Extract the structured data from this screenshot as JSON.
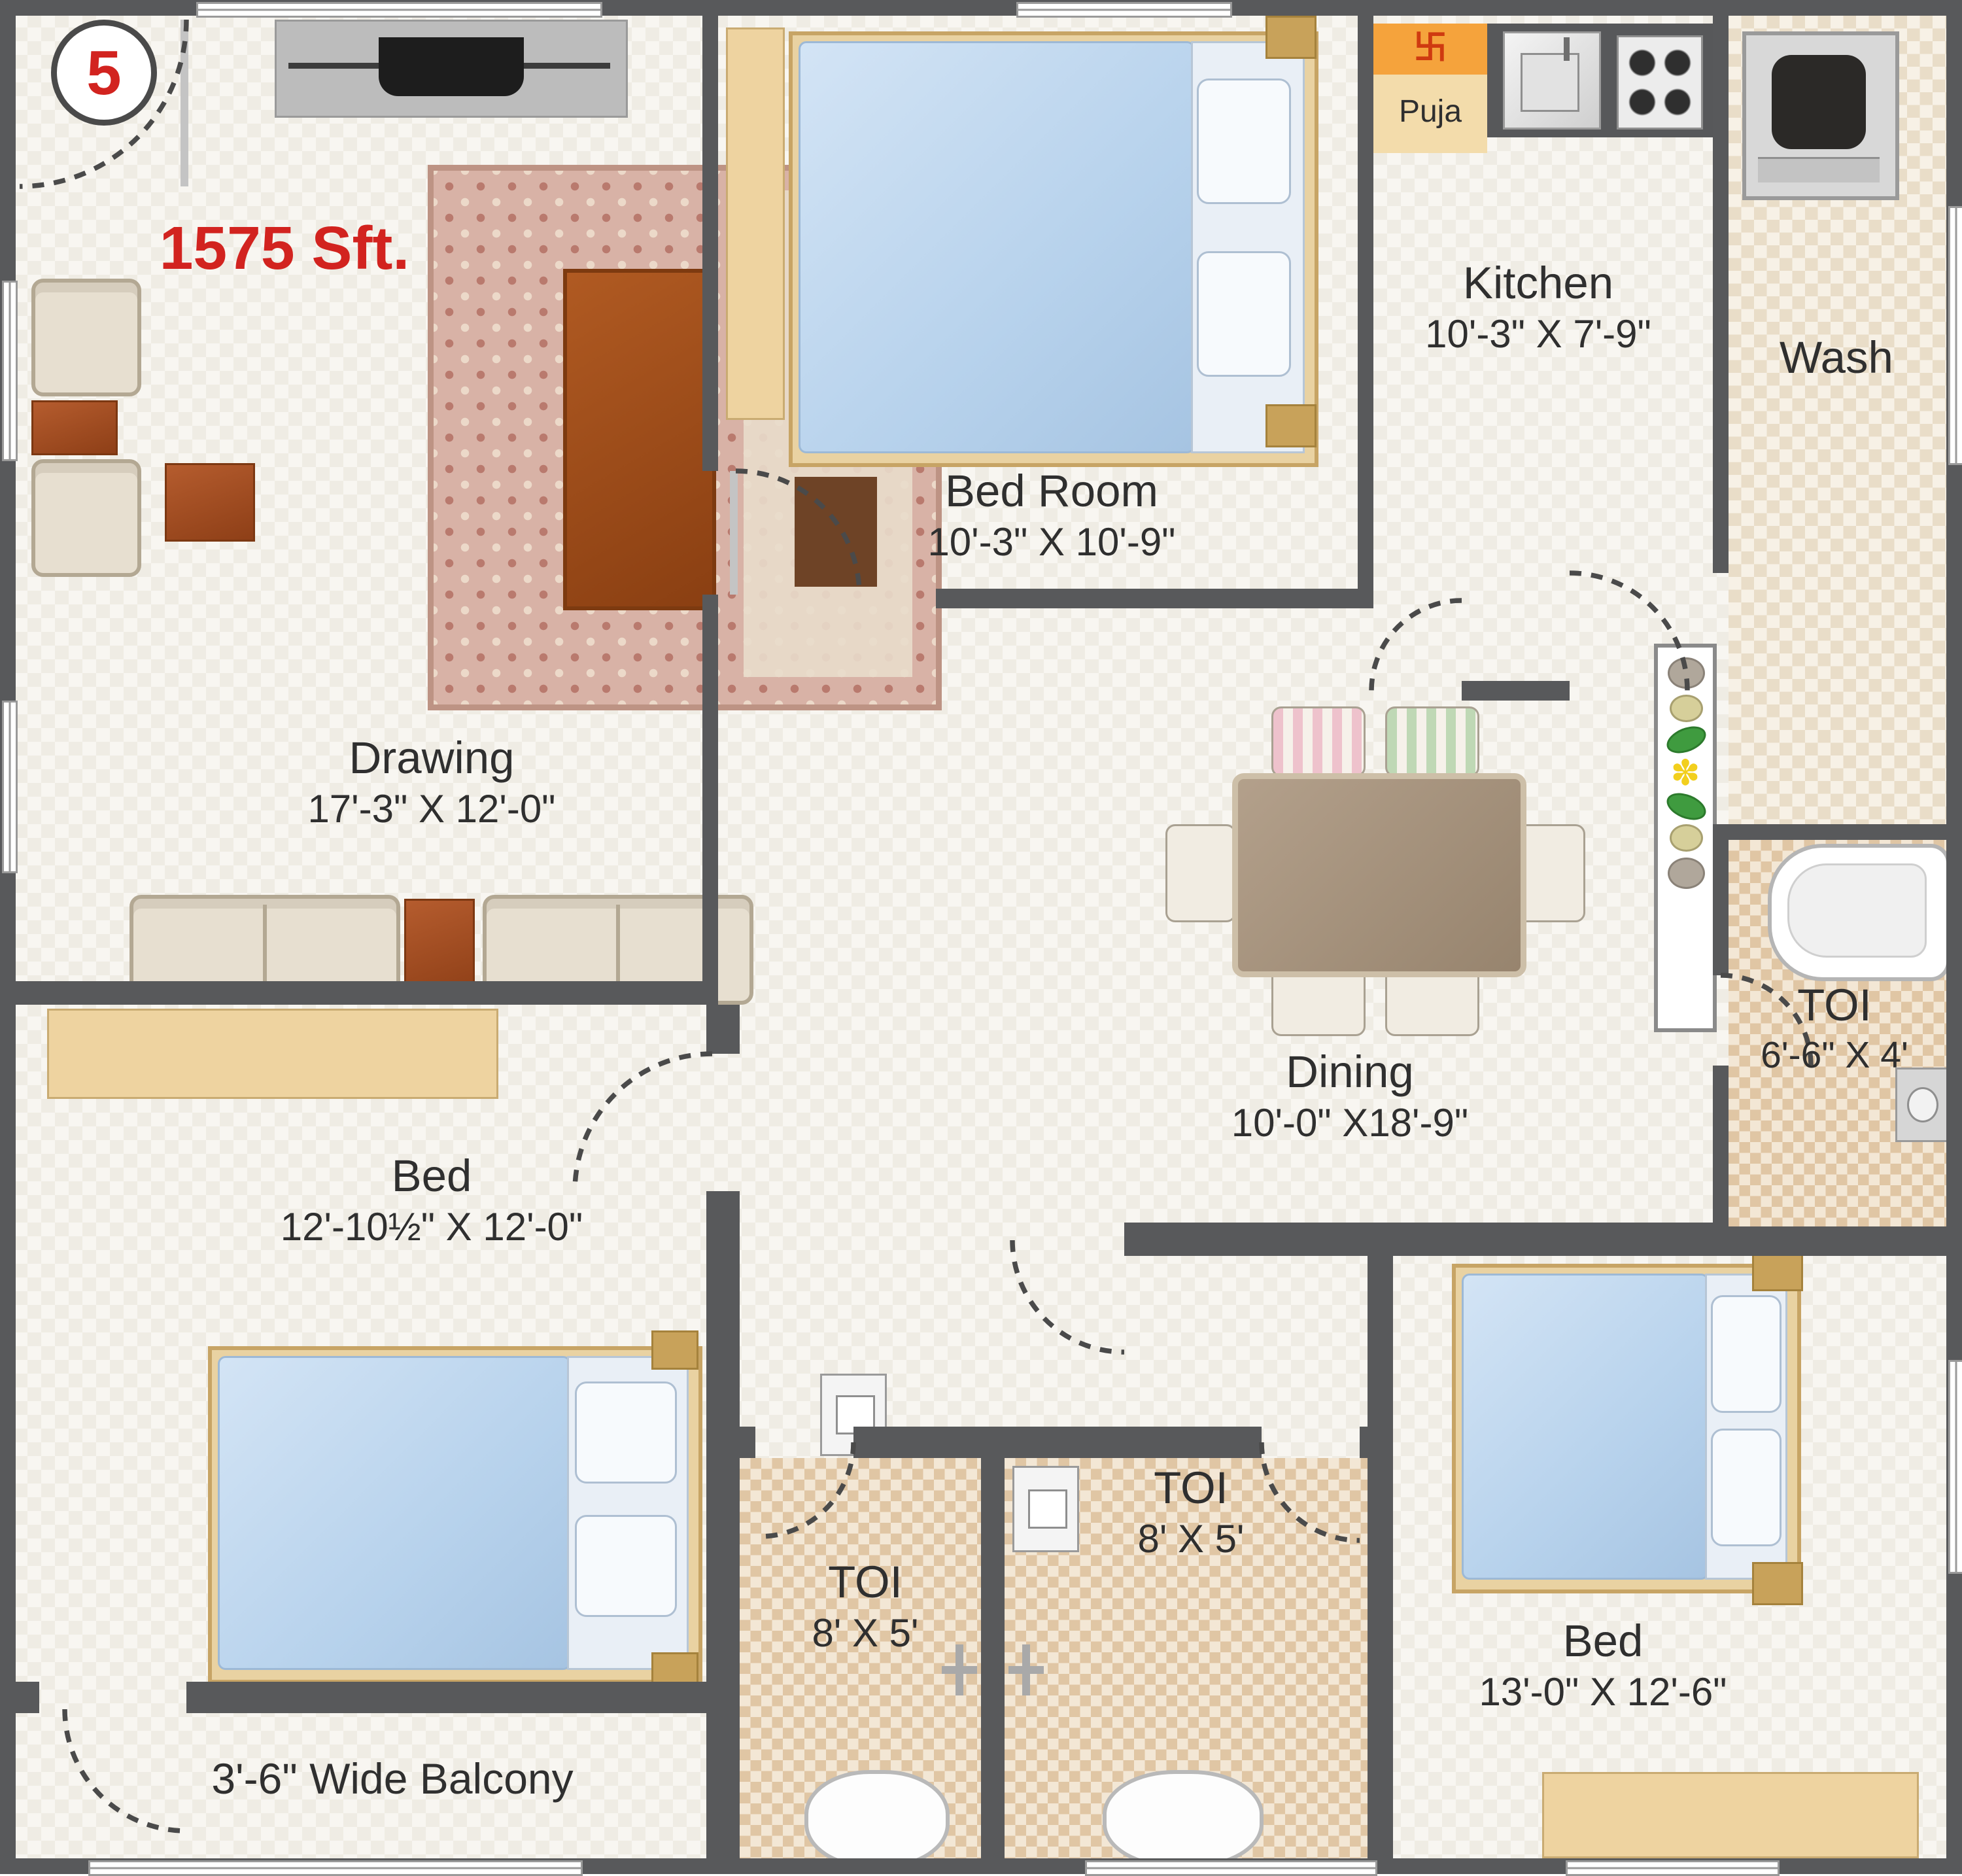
{
  "plan": {
    "unit_number": "5",
    "total_area": "1575 Sft.",
    "rooms": {
      "drawing": {
        "name": "Drawing",
        "dims": "17'-3\" X 12'-0\""
      },
      "bed_top": {
        "name": "Bed Room",
        "dims": "10'-3\" X 10'-9\""
      },
      "kitchen": {
        "name": "Kitchen",
        "dims": "10'-3\" X 7'-9\""
      },
      "puja": {
        "name": "Puja"
      },
      "wash": {
        "name": "Wash"
      },
      "dining": {
        "name": "Dining",
        "dims": "10'-0\" X18'-9\""
      },
      "toi_attached": {
        "name": "TOI",
        "dims": "6'-6\" X 4'"
      },
      "bed_left": {
        "name": "Bed",
        "dims": "12'-10½\" X 12'-0\""
      },
      "toi_left": {
        "name": "TOI",
        "dims": "8' X 5'"
      },
      "toi_right": {
        "name": "TOI",
        "dims": "8' X 5'"
      },
      "bed_right": {
        "name": "Bed",
        "dims": "13'-0\" X 12'-6\""
      },
      "balcony": {
        "name": "3'-6\" Wide Balcony"
      }
    },
    "icons": {
      "puja_symbol": "卐",
      "flower": "✽"
    },
    "colors": {
      "wall": "#58595b",
      "accent_red": "#d2231f",
      "puja_orange": "#f5a33c",
      "puja_body": "#f3dcab",
      "tile": "#e0c6a4",
      "floor": "#f8f6f1",
      "wood": "#eed3a0",
      "mattress_blue": "#b7d2ec",
      "table_brown": "#a9542c"
    }
  }
}
